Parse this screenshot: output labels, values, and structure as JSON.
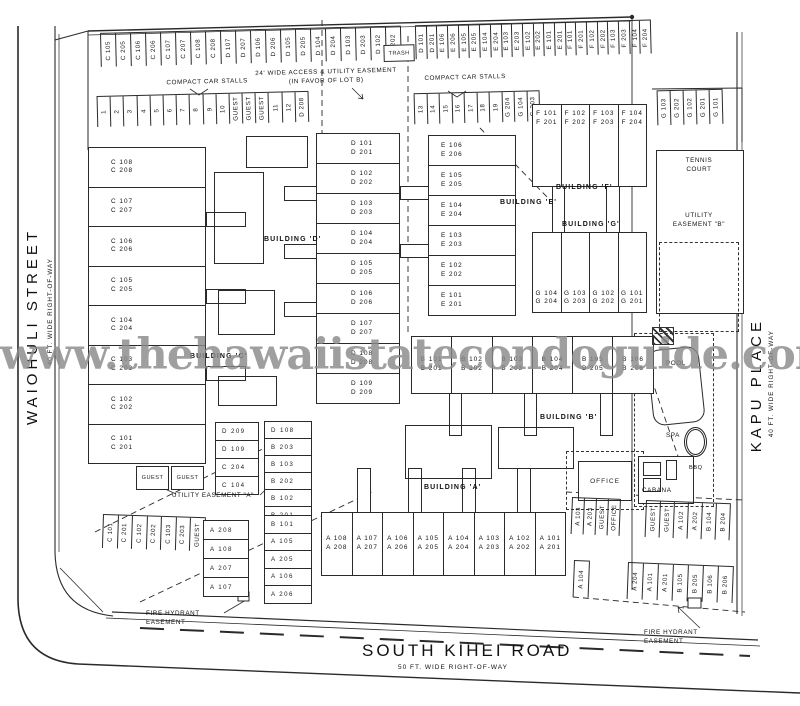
{
  "watermark": "www.thehawaiistatecondoguide.com",
  "colors": {
    "line": "#2a2a2a",
    "watermark": "#8a8a8a"
  },
  "streets": {
    "west": {
      "name": "WAIOHULI STREET",
      "row": "40 FT. WIDE RIGHT-OF-WAY"
    },
    "east": {
      "name": "KAPU PLACE",
      "row": "40 FT. WIDE RIGHT-OF-WAY"
    },
    "south": {
      "name": "SOUTH KIHEI ROAD",
      "row": "50 FT. WIDE RIGHT-OF-WAY"
    }
  },
  "site_labels": {
    "compact_car_stalls": "COMPACT CAR STALLS",
    "access_easement": "24' WIDE ACCESS & UTILITY EASEMENT\n(IN FAVOR OF LOT B)",
    "trash": "TRASH",
    "tennis_court": "TENNIS\nCOURT",
    "utility_easement_a": "UTILITY EASEMENT \"A\"",
    "utility_easement_b": "UTILITY\nEASEMENT \"B\"",
    "pool": "POOL",
    "spa": "SPA",
    "bbq": "BBQ",
    "cabana": "CABANA",
    "office": "OFFICE",
    "fire_hydrant_easement": "FIRE HYDRANT\nEASEMENT"
  },
  "buildings": {
    "a": {
      "name": "BUILDING 'A'",
      "units": [
        "A 108\nA 208",
        "A 107\nA 207",
        "A 106\nA 206",
        "A 105\nA 205",
        "A 104\nA 204",
        "A 103\nA 203",
        "A 102\nA 202",
        "A 101\nA 201"
      ]
    },
    "b": {
      "name": "BUILDING 'B'",
      "units": [
        "B 101\nB 201",
        "B 102\nB 202",
        "B 103\nB 203",
        "B 104\nB 204",
        "B 105\nB 205",
        "B 106\nB 206"
      ]
    },
    "c": {
      "name": "BUILDING 'C'",
      "units": [
        "C 108\nC 208",
        "C 107\nC 207",
        "C 106\nC 206",
        "C 105\nC 205",
        "C 104\nC 204",
        "C 103\nC 203",
        "C 102\nC 202",
        "C 101\nC 201"
      ]
    },
    "d": {
      "name": "BUILDING 'D'",
      "units": [
        "D 101\nD 201",
        "D 102\nD 202",
        "D 103\nD 203",
        "D 104\nD 204",
        "D 105\nD 205",
        "D 106\nD 206",
        "D 107\nD 207",
        "D 108\nD 208",
        "D 109\nD 209"
      ]
    },
    "e": {
      "name": "BUILDING 'E'",
      "units": [
        "E 106\nE 206",
        "E 105\nE 205",
        "E 104\nE 204",
        "E 103\nE 203",
        "E 102\nE 202",
        "E 101\nE 201"
      ]
    },
    "f": {
      "name": "BUILDING 'F'",
      "units": [
        "F 101\nF 201",
        "F 102\nF 202",
        "F 103\nF 203",
        "F 104\nF 204"
      ]
    },
    "g": {
      "name": "BUILDING 'G'",
      "units": [
        "G 104\nG 204",
        "G 103\nG 203",
        "G 102\nG 202",
        "G 101\nG 201"
      ]
    }
  },
  "parking": {
    "top_row_1": [
      "C 105",
      "C 205",
      "C 106",
      "C 206",
      "C 107",
      "C 207",
      "C 108",
      "C 208",
      "D 107",
      "D 207",
      "D 106",
      "D 206",
      "D 105",
      "D 205",
      "D 104",
      "D 204",
      "D 103",
      "D 203",
      "D 102",
      "D 202"
    ],
    "top_row_2": [
      "D 101",
      "D 201",
      "E 106",
      "E 206",
      "E 105",
      "E 205",
      "E 104",
      "E 204",
      "E 103",
      "E 203",
      "E 102",
      "E 202",
      "E 101",
      "E 201",
      "F 101",
      "F 201",
      "F 102",
      "F 202",
      "F 103",
      "F 203",
      "F 104",
      "F 204"
    ],
    "row2_left": [
      "1",
      "2",
      "3",
      "4",
      "5",
      "6",
      "7",
      "8",
      "9",
      "10",
      "GUEST",
      "GUEST",
      "GUEST",
      "11",
      "12",
      "D 208"
    ],
    "row2_right": [
      "13",
      "14",
      "15",
      "16",
      "17",
      "18",
      "19",
      "G 204",
      "G 104",
      "G 203"
    ],
    "row2_far_right": [
      "G 103",
      "G 202",
      "G 102",
      "G 201",
      "G 101"
    ],
    "left_col_1": [
      "D 209",
      "D 109",
      "C 204",
      "C 104"
    ],
    "left_col_2": [
      "D 108",
      "B 203",
      "B 103",
      "B 202",
      "B 102",
      "B 201"
    ],
    "left_col_3": [
      "B 101",
      "A 105",
      "A 205",
      "A 106",
      "A 206"
    ],
    "left_col_4": [
      "A 208",
      "A 108",
      "A 207",
      "A 107"
    ],
    "guest_pair": [
      "GUEST",
      "GUEST"
    ],
    "bottom_left": [
      "C 101",
      "C 201",
      "C 102",
      "C 202",
      "C 103",
      "C 203",
      "GUEST"
    ],
    "br_row1_a": [
      "A 103",
      "A 203",
      "GUEST",
      "OFFICE"
    ],
    "br_row1_b": [
      "GUEST",
      "GUEST",
      "A 102",
      "A 202",
      "B 104",
      "B 204"
    ],
    "br_row2_a": [
      "A 104"
    ],
    "br_row2_b": [
      "A 204",
      "A 101",
      "A 201",
      "B 105",
      "B 205",
      "B 106",
      "B 206"
    ]
  }
}
